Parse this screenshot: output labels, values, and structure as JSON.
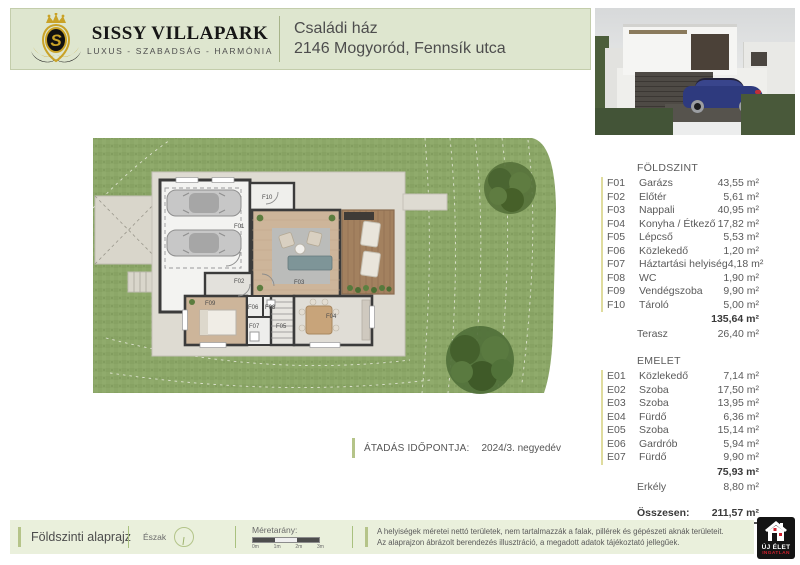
{
  "header": {
    "brand_name": "SISSY VILLAPARK",
    "brand_tagline": "LUXUS - SZABADSÁG - HARMÓNIA",
    "title_line1": "Családi ház",
    "title_line2": "2146 Mogyoród, Fennsík utca"
  },
  "room_schedule": {
    "ground": {
      "heading": "FÖLDSZINT",
      "rows": [
        {
          "code": "F01",
          "name": "Garázs",
          "area": "43,55 m²"
        },
        {
          "code": "F02",
          "name": "Előtér",
          "area": "5,61 m²"
        },
        {
          "code": "F03",
          "name": "Nappali",
          "area": "40,95 m²"
        },
        {
          "code": "F04",
          "name": "Konyha / Étkező",
          "area": "17,82 m²"
        },
        {
          "code": "F05",
          "name": "Lépcső",
          "area": "5,53 m²"
        },
        {
          "code": "F06",
          "name": "Közlekedő",
          "area": "1,20 m²"
        },
        {
          "code": "F07",
          "name": "Háztartási helyiség",
          "area": "4,18 m²"
        },
        {
          "code": "F08",
          "name": "WC",
          "area": "1,90 m²"
        },
        {
          "code": "F09",
          "name": "Vendégszoba",
          "area": "9,90 m²"
        },
        {
          "code": "F10",
          "name": "Tároló",
          "area": "5,00 m²"
        }
      ],
      "total": "135,64 m²",
      "extra_name": "Terasz",
      "extra_area": "26,40 m²"
    },
    "upper": {
      "heading": "EMELET",
      "rows": [
        {
          "code": "E01",
          "name": "Közlekedő",
          "area": "7,14 m²"
        },
        {
          "code": "E02",
          "name": "Szoba",
          "area": "17,50 m²"
        },
        {
          "code": "E03",
          "name": "Szoba",
          "area": "13,95 m²"
        },
        {
          "code": "E04",
          "name": "Fürdő",
          "area": "6,36 m²"
        },
        {
          "code": "E05",
          "name": "Szoba",
          "area": "15,14 m²"
        },
        {
          "code": "E06",
          "name": "Gardrób",
          "area": "5,94 m²"
        },
        {
          "code": "E07",
          "name": "Fürdő",
          "area": "9,90 m²"
        }
      ],
      "total": "75,93 m²",
      "extra_name": "Erkély",
      "extra_area": "8,80 m²"
    },
    "grand_total_label": "Összesen:",
    "grand_total": "211,57 m²"
  },
  "handover": {
    "label": "ÁTADÁS IDŐPONTJA:",
    "value": "2024/3. negyedév"
  },
  "plan": {
    "labels": {
      "f01": "F01",
      "f02": "F02",
      "f03": "F03",
      "f04": "F04",
      "f05": "F05",
      "f06": "F06",
      "f07": "F07",
      "f08": "F08",
      "f09": "F09",
      "f10": "F10"
    }
  },
  "footer": {
    "plan_label": "Földszinti alaprajz",
    "north_label": "Észak",
    "scale_label": "Méretarány:",
    "scale_ticks": [
      "0m",
      "1m",
      "2m",
      "3m"
    ],
    "disclaimer_line1": "A helyiségek méretei nettó területek, nem tartalmazzák a falak, pillérek és gépészeti aknák területeit.",
    "disclaimer_line2": "Az alaprajzon ábrázolt berendezés illusztráció, a megadott adatok tájékoztató jellegűek."
  },
  "agency": {
    "line1": "ÚJ ÉLET",
    "line2": "INGATLAN"
  },
  "colors": {
    "header_bg": "#dee6cf",
    "footer_bg": "#eaf0dc",
    "accent_bar": "#b5c489",
    "grass": "#8ca768",
    "wall": "#3b3b3b",
    "wood": "#cdb59a",
    "deck": "#a3815f",
    "agency_red": "#d0202e",
    "brand_gold": "#c9a227"
  }
}
